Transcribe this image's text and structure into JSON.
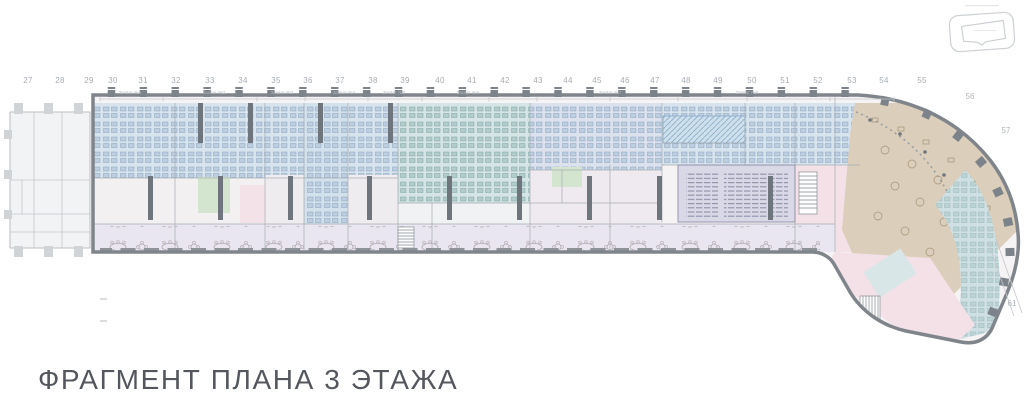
{
  "title": {
    "text": "ФРАГМЕНТ ПЛАНА 3 ЭТАЖА"
  },
  "key_plan": {
    "name": "building-location-key"
  },
  "grid": {
    "top_columns": [
      {
        "label": "27",
        "x": 28
      },
      {
        "label": "28",
        "x": 60
      },
      {
        "label": "29",
        "x": 89
      },
      {
        "label": "30",
        "x": 113
      },
      {
        "label": "31",
        "x": 143
      },
      {
        "label": "32",
        "x": 176
      },
      {
        "label": "33",
        "x": 210
      },
      {
        "label": "34",
        "x": 243
      },
      {
        "label": "35",
        "x": 276
      },
      {
        "label": "36",
        "x": 308
      },
      {
        "label": "37",
        "x": 340
      },
      {
        "label": "38",
        "x": 373
      },
      {
        "label": "39",
        "x": 405
      },
      {
        "label": "40",
        "x": 440
      },
      {
        "label": "41",
        "x": 472
      },
      {
        "label": "42",
        "x": 505
      },
      {
        "label": "43",
        "x": 538
      },
      {
        "label": "44",
        "x": 568
      },
      {
        "label": "45",
        "x": 597
      },
      {
        "label": "46",
        "x": 625
      },
      {
        "label": "47",
        "x": 655
      },
      {
        "label": "48",
        "x": 686
      },
      {
        "label": "49",
        "x": 718
      },
      {
        "label": "50",
        "x": 752
      },
      {
        "label": "51",
        "x": 785
      },
      {
        "label": "52",
        "x": 818
      },
      {
        "label": "53",
        "x": 852
      },
      {
        "label": "54",
        "x": 884
      },
      {
        "label": "55",
        "x": 922
      }
    ],
    "side_columns": [
      {
        "label": "56",
        "x": 970,
        "y": 92
      },
      {
        "label": "57",
        "x": 1006,
        "y": 126
      },
      {
        "label": "61",
        "x": 1012,
        "y": 299
      }
    ]
  },
  "dimensions": {
    "labels": [
      {
        "text": "Захват №1",
        "x": 130
      },
      {
        "text": "Захват №2",
        "x": 214
      },
      {
        "text": "Захват №3",
        "x": 282
      },
      {
        "text": "Захват №4",
        "x": 344
      },
      {
        "text": "Захват №5",
        "x": 394
      },
      {
        "text": "Захват №6",
        "x": 468
      },
      {
        "text": "Захват №7",
        "x": 610
      },
      {
        "text": "Захват №8",
        "x": 747
      }
    ]
  },
  "zones": {
    "open_office_blue": "#d7e4ee",
    "open_office_cyan": "#d5e4e5",
    "auditorium_lavender": "#d9d8e6",
    "cafe_tan": "#dbceba",
    "meeting_green": "#d3e5cf",
    "rooms_pink": "#f3e1e7",
    "corridor_lavender": "#e9e6f1",
    "perimeter_blue": "#cfe0e5",
    "walls_gray": "#7f858b"
  }
}
